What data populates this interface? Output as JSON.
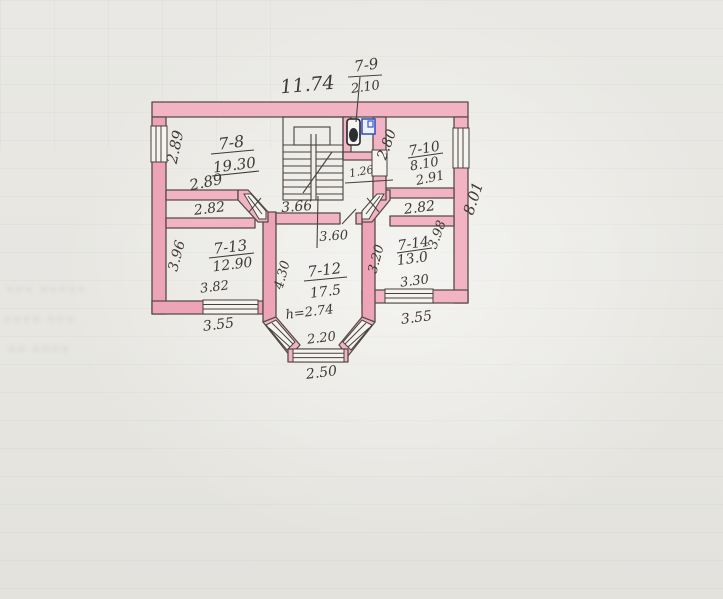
{
  "plan": {
    "top_width": "11.74",
    "right_height": "8.01",
    "corridor_center": "3.66",
    "rooms": {
      "r78": {
        "label": "7-8",
        "area": "19.30",
        "side": "2.89",
        "width": "2.89"
      },
      "r79": {
        "label": "7-9",
        "area": "2.10"
      },
      "r710": {
        "label": "7-10",
        "area": "8.10",
        "width": "2.91",
        "depth": "2.80",
        "door": "1.26"
      },
      "r712": {
        "label": "7-12",
        "area": "17.5",
        "height": "h=2.74",
        "depth": "4.30",
        "top_width": "3.60",
        "bay_width": "2.20",
        "bay_outer": "2.50"
      },
      "r713": {
        "label": "7-13",
        "area": "12.90",
        "depth": "3.96",
        "top": "2.82",
        "bottom": "3.82",
        "window": "3.55"
      },
      "r714": {
        "label": "7-14",
        "area": "13.0",
        "left": "3.20",
        "right": "3.98",
        "top": "2.82",
        "bottom": "3.30",
        "window": "3.55"
      }
    },
    "colors": {
      "wall_fill": "#f2b4c4",
      "ink": "#3f3a35",
      "fixture_blue": "#3b55c4",
      "paper": "#e9e8e4"
    }
  }
}
